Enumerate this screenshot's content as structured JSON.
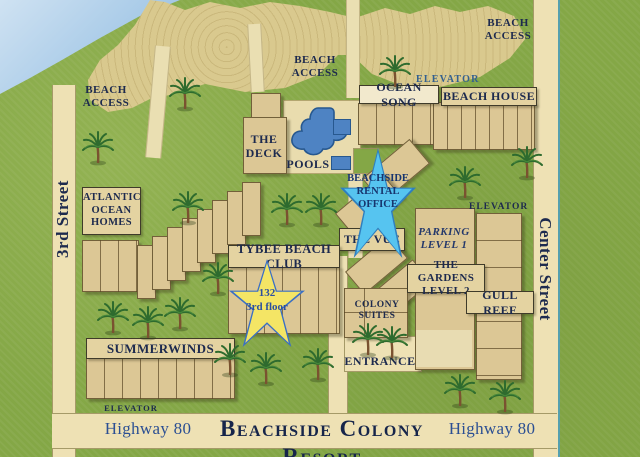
{
  "map_title": "Beachside Colony Resort",
  "streets": {
    "third": "3rd Street",
    "center": "Center Street",
    "highway": "Highway 80"
  },
  "labels": {
    "beach_access_line1": "BEACH",
    "beach_access_line2": "ACCESS",
    "elevator": "ELEVATOR",
    "entrance": "ENTRANCE",
    "pools": "POOLS"
  },
  "buildings": {
    "ocean_song": "OCEAN SONG",
    "beach_house": "BEACH HOUSE",
    "deck_line1": "THE",
    "deck_line2": "DECK",
    "atlantic_line1": "ATLANTIC",
    "atlantic_line2": "OCEAN",
    "atlantic_line3": "HOMES",
    "vue": "THE VUE",
    "parking_line1": "PARKING",
    "parking_line2": "LEVEL 1",
    "gardens_line1": "THE GARDENS",
    "gardens_line2": "LEVEL 2",
    "gull_reef": "GULL REEF",
    "tybee": "TYBEE BEACH CLUB",
    "colony_line1": "COLONY",
    "colony_line2": "SUITES",
    "summerwinds": "SUMMERWINDS"
  },
  "markers": {
    "rental_line1": "BEACHSIDE",
    "rental_line2": "RENTAL",
    "rental_line3": "OFFICE",
    "unit_line1": "132",
    "unit_line2": "3rd floor"
  },
  "colors": {
    "grass": "#84a746",
    "sand": "#d9c98e",
    "road": "#eee1b4",
    "building": "#dcc795",
    "water": "#a9cbe8",
    "pool": "#4e83c3",
    "navy_text": "#1d2a4e",
    "blue_text": "#2b4f93",
    "rental_star": "#56c4f0",
    "unit_star": "#f4e565"
  }
}
